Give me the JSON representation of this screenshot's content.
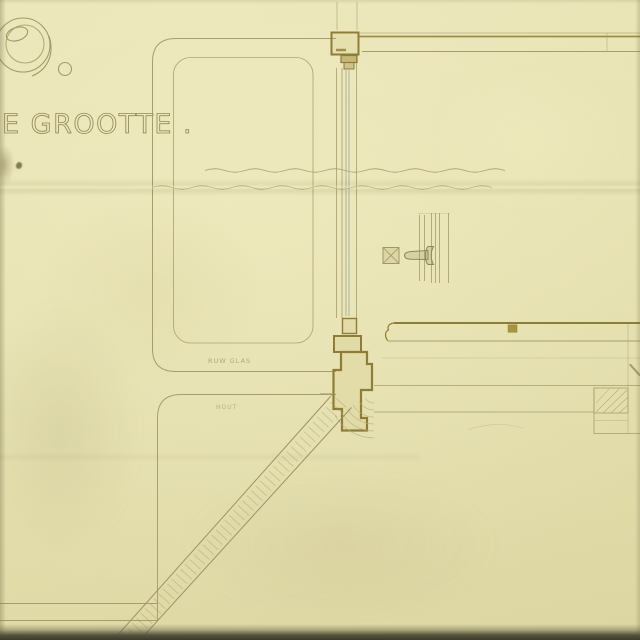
{
  "sheet": {
    "number": "9.",
    "title": "E GROOTTE .",
    "annotation_labels": {
      "panel_material": "RUW GLAS",
      "lower_material": "HOUT"
    }
  },
  "palette": {
    "paper": "#e8e3b2",
    "ink_light": "#a79d6c",
    "ink_dark": "#8d7d35",
    "glass_line": "#9fae9b",
    "lettering": "#93895a",
    "wood_plug": "#a28c30",
    "bottom_edge_shadow": "#3d3b2c"
  }
}
